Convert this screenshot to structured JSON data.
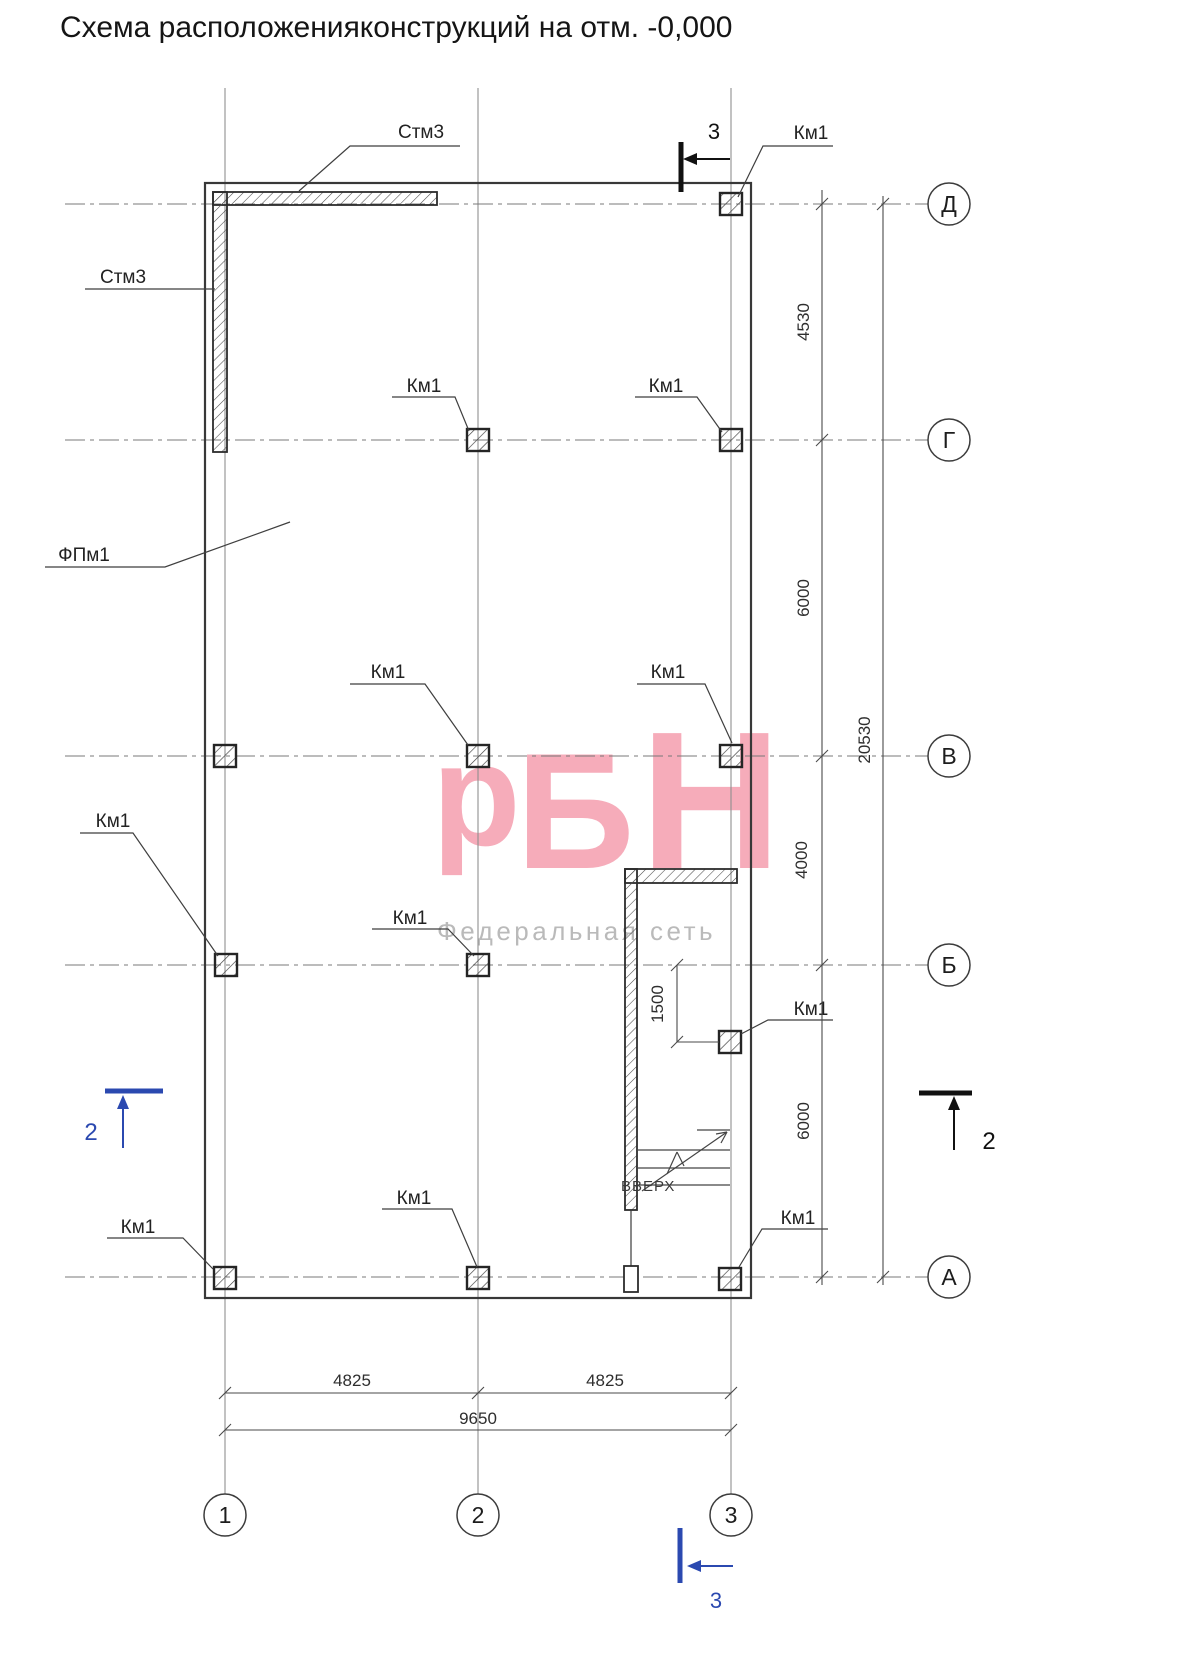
{
  "title": "Схема расположенияконструкций на отм. -0,000",
  "watermark": {
    "logo_p": "р",
    "logo_b": "Б",
    "logo_n": "Н",
    "subtitle": "Федеральная сеть",
    "pink": "#f6acba",
    "gray": "#bababa"
  },
  "grid": {
    "row_labels": [
      "Д",
      "Г",
      "В",
      "Б",
      "А"
    ],
    "col_labels": [
      "1",
      "2",
      "3"
    ]
  },
  "dims": {
    "v_segments": [
      "4530",
      "6000",
      "4000",
      "6000"
    ],
    "v_total": "20530",
    "h_segments": [
      "4825",
      "4825"
    ],
    "h_total": "9650",
    "stair": "1500"
  },
  "tags": {
    "wall": "Стм3",
    "foundation": "ФПм1",
    "column": "Км1",
    "stair_dir": "ВВЕРХ"
  },
  "sections": {
    "s2": "2",
    "s3": "3"
  },
  "colors": {
    "section_blue": "#2b49b0",
    "line_dark": "#3a3a3a",
    "pink": "#f6acba"
  }
}
